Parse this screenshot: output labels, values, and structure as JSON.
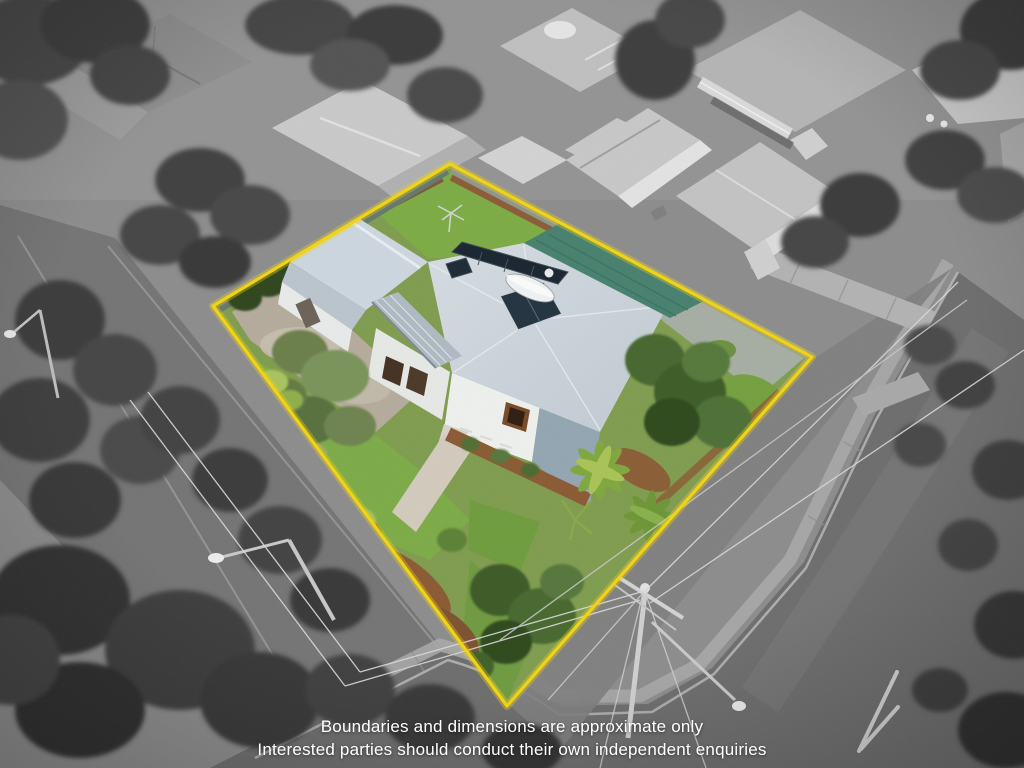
{
  "image": {
    "type": "aerial-property-photo",
    "style": "subject lot in colour inside yellow boundary, surroundings desaturated"
  },
  "overlay": {
    "disclaimer_line1": "Boundaries and dimensions are approximate only",
    "disclaimer_line2": "Interested parties should conduct their own independent enquiries"
  },
  "colors": {
    "boundary": "#f2d411",
    "house_roof": "#cad3d9",
    "shed_roof": "#ccd6de",
    "carport_roof": "#47806e",
    "lawn": "#7dab47",
    "backyard_lawn": "#7cab44",
    "mulch": "#8a5a33",
    "road": "#6d6d6d",
    "disclaimer_text": "#ffffff"
  }
}
